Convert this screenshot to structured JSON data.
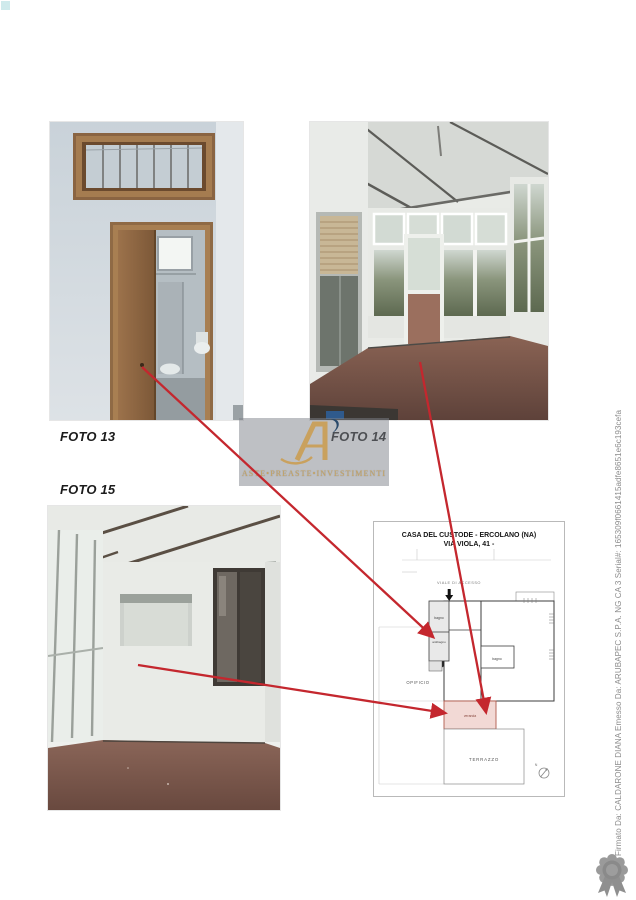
{
  "document": {
    "photo_labels": [
      {
        "id": "foto13",
        "label": "FOTO 13"
      },
      {
        "id": "foto14",
        "label": "FOTO 14"
      },
      {
        "id": "foto15",
        "label": "FOTO 15"
      }
    ]
  },
  "watermark": {
    "brand": "ASTE•PREASTE•INVESTIMENTI"
  },
  "floor_plan": {
    "title_line1": "CASA DEL CUSTODE - ERCOLANO (NA)",
    "title_line2": "VIA VIOLA, 41 -",
    "labels": {
      "access_path": "VIALE DI ACCESSO",
      "bagno_upper": "bagno",
      "antibagno": "antibagno",
      "bagno_right": "bagno",
      "opificio": "OPIFICIO",
      "veranda": "veranda",
      "terrazzo": "TERRAZZO",
      "north": "N"
    }
  },
  "signature_sidebar": {
    "text": "Firmato Da: CALDARONE DIANA Emesso Da: ARUBAPEC S.P.A. NG CA 3 Serial#: 165309f0661415adfe8651e6c193cefa"
  },
  "colors": {
    "arrow_red": "#c4272e",
    "watermark_gold": "#c8a45f",
    "watermark_navy": "#2a4a6b",
    "veranda_fill": "#f2d9d5"
  }
}
